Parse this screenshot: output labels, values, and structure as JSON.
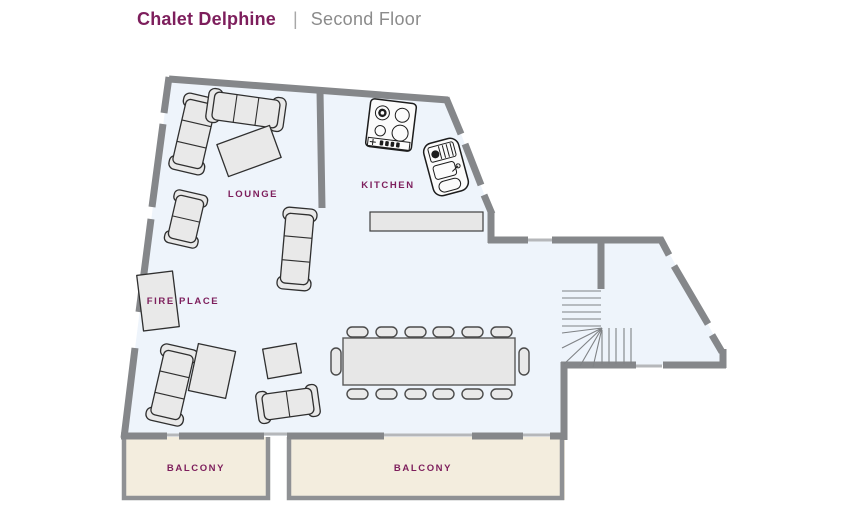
{
  "header": {
    "title": "Chalet Delphine",
    "separator": "|",
    "subtitle": "Second Floor"
  },
  "floorplan": {
    "rooms": [
      {
        "id": "lounge",
        "label": "LOUNGE"
      },
      {
        "id": "kitchen",
        "label": "KITCHEN"
      },
      {
        "id": "fireplace",
        "label": "FIRE PLACE"
      },
      {
        "id": "balcony-left",
        "label": "BALCONY"
      },
      {
        "id": "balcony-right",
        "label": "BALCONY"
      }
    ],
    "dining_table": {
      "chairs_top": 6,
      "chairs_bottom": 6,
      "chairs_ends": 2,
      "total_chairs": 14
    },
    "furniture_icons": [
      "corner-sofa",
      "three-seat-sofa",
      "two-seat-sofa",
      "coffee-table",
      "side-table",
      "fireplace",
      "dining-table",
      "dining-chair",
      "kitchen-counter",
      "stove-hob",
      "kitchen-sink",
      "staircase"
    ]
  },
  "colors": {
    "accent_purple": "#7d1e5c",
    "subtitle_gray": "#8b8b8b",
    "wall_gray": "#85878a",
    "door_gray": "#b5b7ba",
    "floor_fill": "#eef4fb",
    "balcony_fill": "#f3edde",
    "balcony_wall": "#8f9194",
    "stair_line": "#7f8285",
    "furniture_fill": "#e9e9e9",
    "furniture_stroke": "#2f2f2f",
    "table_fill": "#e7e7e7",
    "appliance_fill": "#fbfbfb"
  }
}
